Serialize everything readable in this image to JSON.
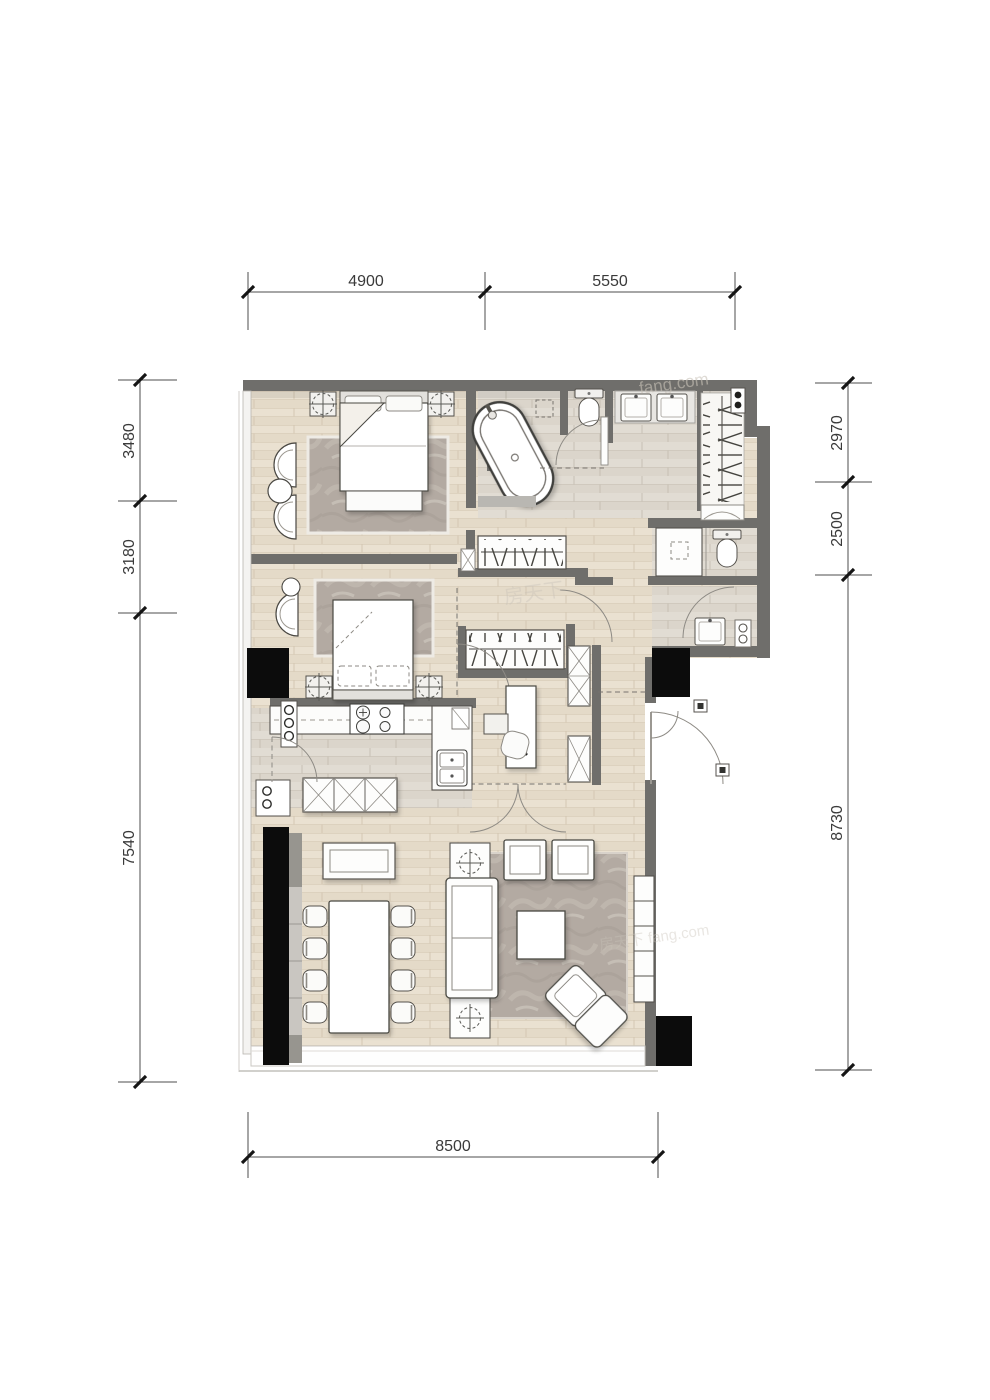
{
  "plan": {
    "type": "apartment-floor-plan",
    "dimensions": {
      "top": [
        "4900",
        "5550"
      ],
      "left": [
        "3480",
        "3180",
        "7540"
      ],
      "right": [
        "2970",
        "2500",
        "8730"
      ],
      "bottom": [
        "8500"
      ]
    },
    "watermarks": [
      "fang.com",
      "房天下",
      "房天下 fang.com"
    ],
    "colors": {
      "wall": "#6f6e6b",
      "floor_wood": "#eae1d1",
      "floor_tile": "#dedad2",
      "rug_marble": "#b3aaa2",
      "column_black": "#0c0c0c",
      "furniture_stroke": "#4a4843",
      "dimension_text": "#3a3a3a"
    }
  }
}
